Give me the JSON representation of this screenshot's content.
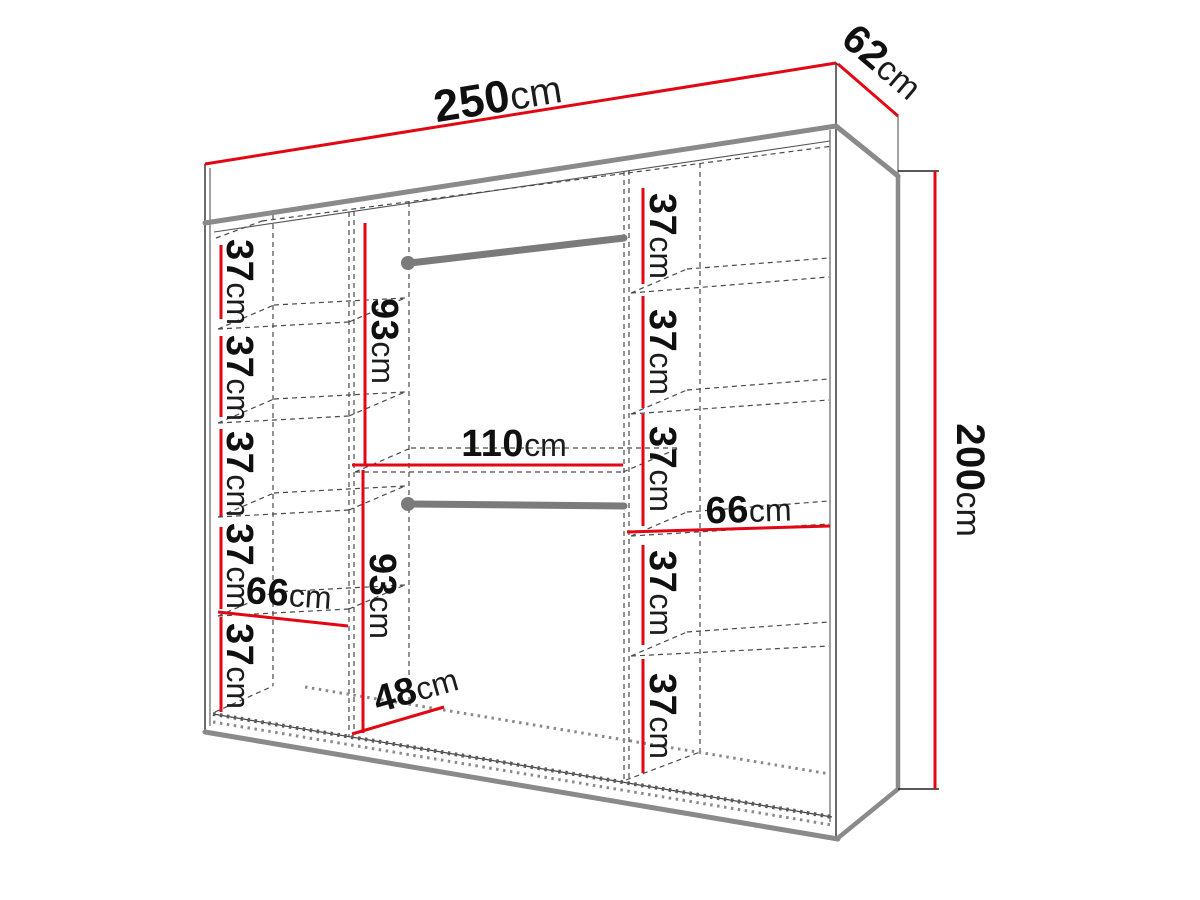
{
  "diagram": {
    "kind": "wardrobe-dimension-diagram",
    "units": "cm",
    "overall_dimensions": {
      "width": {
        "value": "250",
        "unit": "cm"
      },
      "depth": {
        "value": "62",
        "unit": "cm"
      },
      "height": {
        "value": "200",
        "unit": "cm"
      }
    },
    "left_column": {
      "width": {
        "value": "66",
        "unit": "cm"
      },
      "shelf_heights": [
        {
          "value": "37",
          "unit": "cm"
        },
        {
          "value": "37",
          "unit": "cm"
        },
        {
          "value": "37",
          "unit": "cm"
        },
        {
          "value": "37",
          "unit": "cm"
        },
        {
          "value": "37",
          "unit": "cm"
        }
      ]
    },
    "middle_column": {
      "width": {
        "value": "110",
        "unit": "cm"
      },
      "hanging_sections": [
        {
          "value": "93",
          "unit": "cm"
        },
        {
          "value": "93",
          "unit": "cm"
        }
      ],
      "floor_depth": {
        "value": "48",
        "unit": "cm"
      },
      "rail_count": 2
    },
    "right_column": {
      "width": {
        "value": "66",
        "unit": "cm"
      },
      "shelf_heights": [
        {
          "value": "37",
          "unit": "cm"
        },
        {
          "value": "37",
          "unit": "cm"
        },
        {
          "value": "37",
          "unit": "cm"
        },
        {
          "value": "37",
          "unit": "cm"
        },
        {
          "value": "37",
          "unit": "cm"
        }
      ]
    },
    "colors": {
      "dimension_line": "#e30613",
      "structure_gray": "#8a8a8a",
      "rail_gray": "#7b7b7b"
    }
  }
}
